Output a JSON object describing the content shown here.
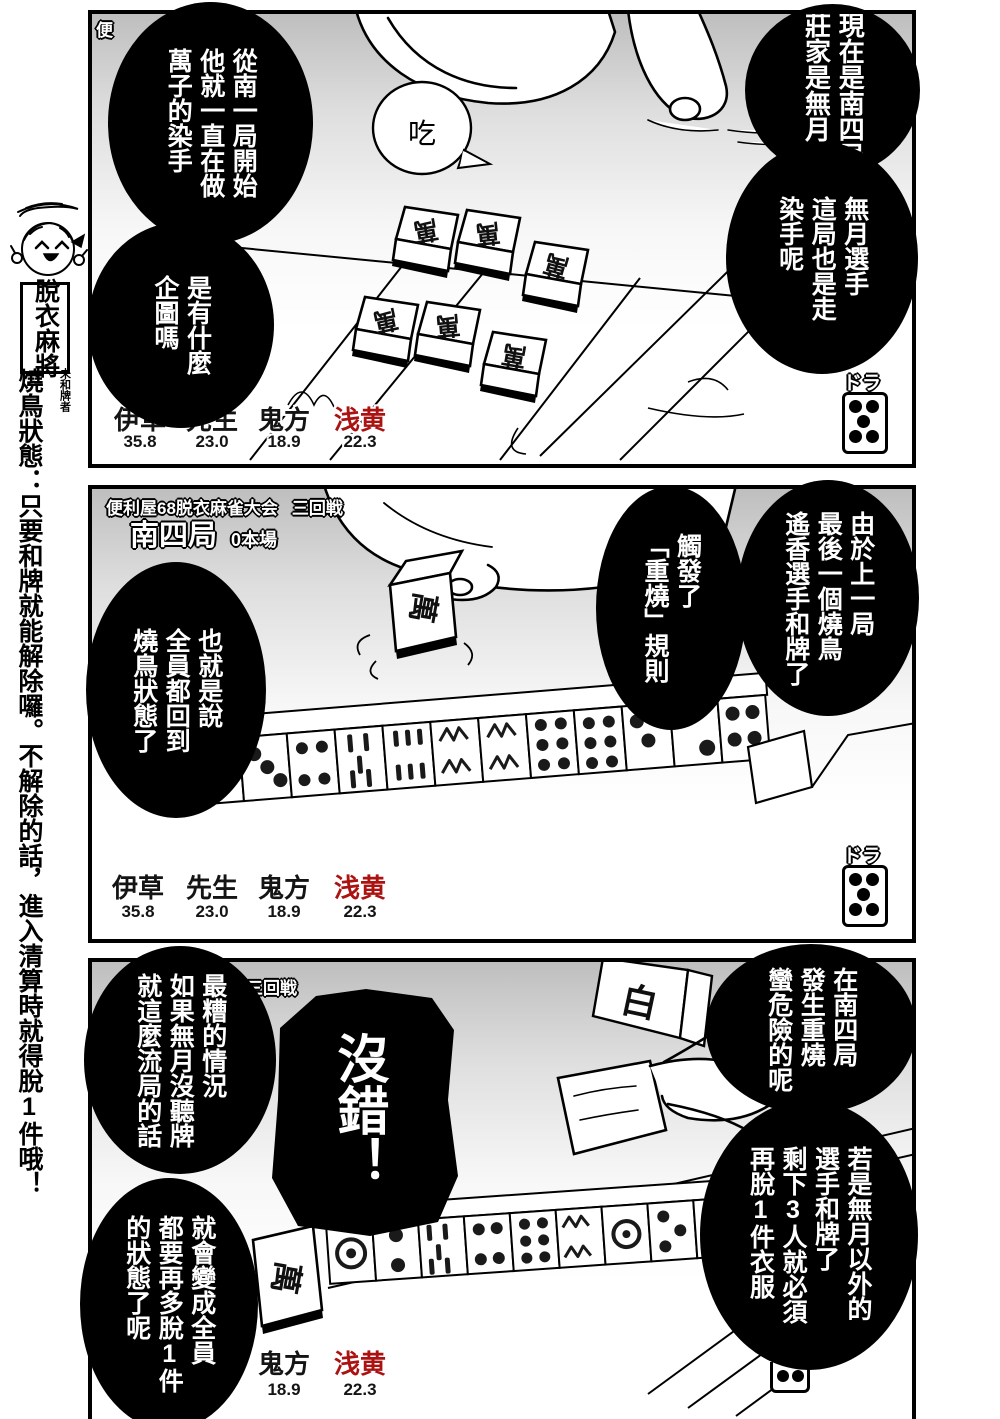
{
  "colors": {
    "ink": "#000000",
    "name_red": "#ab1212",
    "panel_gray": "#bdbdbd"
  },
  "sidebar": {
    "series_title": "脫衣麻將",
    "badge": "未和牌者",
    "rule_note": "燒鳥狀態：只要和牌就能解除囉。不解除的話，進入清算時就得脫1件哦！"
  },
  "panel1": {
    "header_fragment": "便",
    "bubbles": {
      "right_top": "現在是南四局\n莊家是無月",
      "right_bottom": "無月選手\n這局也是走\n染手呢",
      "left_top": "從南一局開始\n他就一直在做\n萬子的染手",
      "left_bottom": "是有什麼\n企圖嗎"
    },
    "call_sfx": "吃",
    "meld_tile_glyph": "萬",
    "dora_label": "ドラ",
    "scoreboard": [
      {
        "name": "伊草",
        "score": "35.8"
      },
      {
        "name": "先生",
        "score": "23.0"
      },
      {
        "name": "鬼方",
        "score": "18.9"
      },
      {
        "name": "浅黄",
        "score": "22.3",
        "red": true
      }
    ]
  },
  "panel2": {
    "tournament": "便利屋68脱衣麻雀大会",
    "round": "三回戦",
    "hand": "南四局",
    "honba": "0本場",
    "bubbles": {
      "right_outer": "由於上一局\n最後一個燒鳥\n遙香選手和牌了",
      "right_inner": "觸發了\n「重燒」規則",
      "left": "也就是說\n全員都回到\n燒鳥狀態了"
    },
    "tile_glyph": "萬",
    "dora_label": "ドラ",
    "scoreboard": [
      {
        "name": "伊草",
        "score": "35.8"
      },
      {
        "name": "先生",
        "score": "23.0"
      },
      {
        "name": "鬼方",
        "score": "18.9"
      },
      {
        "name": "浅黄",
        "score": "22.3",
        "red": true
      }
    ]
  },
  "panel3": {
    "header_fragment": "三回戦",
    "bubbles": {
      "right_top": "在南四局\n發生重燒\n蠻危險的呢",
      "right_bottom": "若是無月以外的\n選手和牌了\n剩下3人就必須\n再脫1件衣服",
      "left_top": "最糟的情況\n如果無月沒聽牌\n就這麼流局的話",
      "left_bottom": "就會變成全員\n都要再多脫1件\n的狀態了呢",
      "center_shout": "沒錯！"
    },
    "discard_tile_glyph": "萬",
    "wall_tile_glyph": "白",
    "scoreboard": [
      {
        "name": "鬼方",
        "score": "18.9"
      },
      {
        "name": "浅黄",
        "score": "22.3",
        "red": true
      }
    ]
  }
}
